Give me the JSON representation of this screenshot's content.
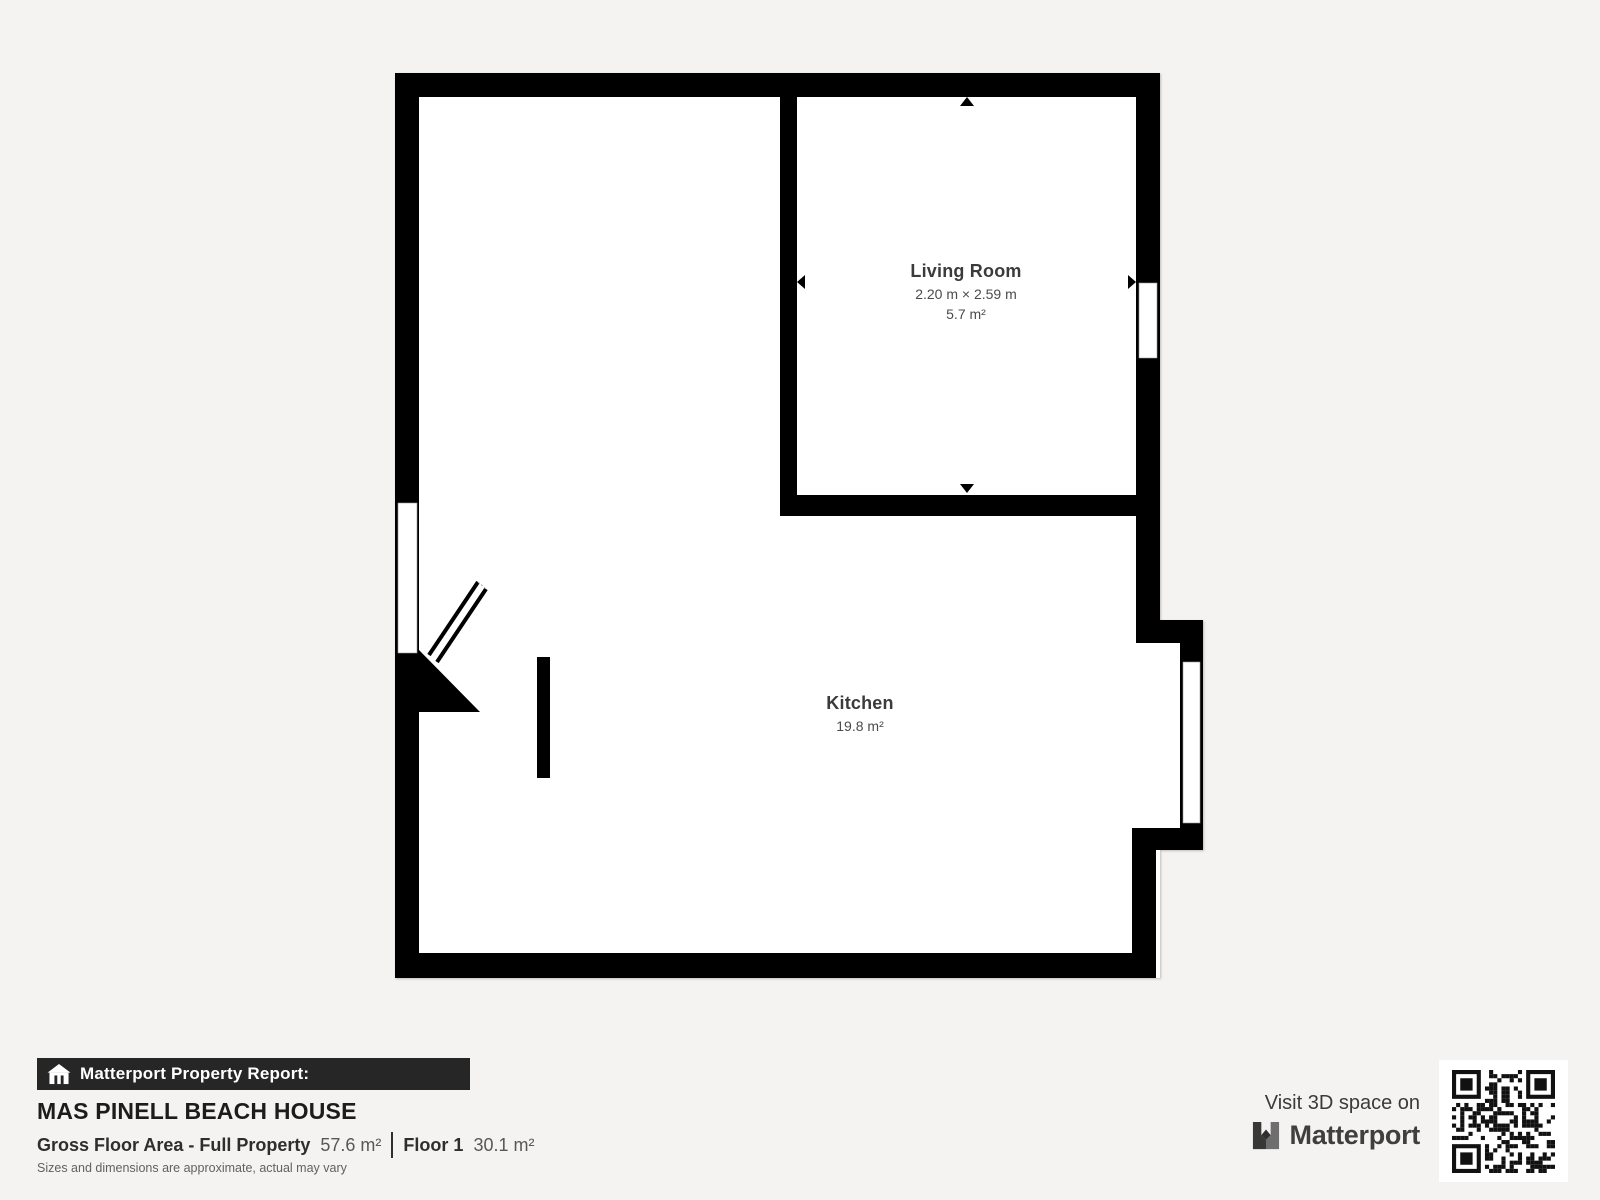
{
  "plan": {
    "living_room": {
      "name": "Living Room",
      "dimensions": "2.20 m × 2.59 m",
      "area": "5.7 m²"
    },
    "kitchen": {
      "name": "Kitchen",
      "area": "19.8 m²"
    }
  },
  "report": {
    "header": "Matterport Property Report:",
    "property_name": "MAS PINELL BEACH HOUSE",
    "gross_floor_label": "Gross Floor Area - Full Property",
    "gross_floor_value": "57.6 m²",
    "floor_label": "Floor 1",
    "floor_value": "30.1 m²",
    "disclaimer": "Sizes and dimensions are approximate, actual may vary"
  },
  "cta": {
    "visit_text": "Visit 3D space on",
    "brand": "Matterport"
  },
  "icons": {
    "house_icon": "house-with-columns",
    "logo_icon": "matterport-m-logo",
    "qr_code": "qr-code",
    "dimension_arrows": [
      "up",
      "down",
      "left",
      "right"
    ]
  },
  "colors": {
    "background": "#f4f3f1",
    "wall": "#000000",
    "room_fill": "#ffffff",
    "header_bar": "#262626",
    "title_text": "#1c1c1c",
    "label_text": "#3b3b3b",
    "disclaimer_text": "#616161"
  }
}
